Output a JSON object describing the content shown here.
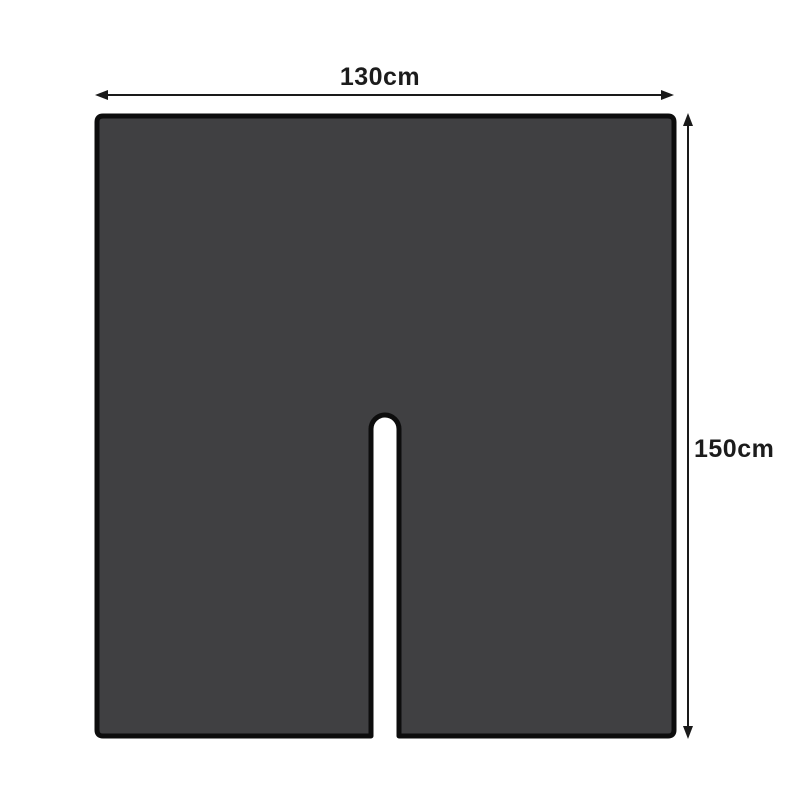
{
  "diagram": {
    "title": "u-shaped-cover-dimension-diagram",
    "width_dimension": {
      "label": "130cm"
    },
    "height_dimension": {
      "label": "150cm"
    },
    "shape": {
      "name": "square-cover-with-center-notch",
      "fill_color": "#404042",
      "outline_color": "#0d0d0d"
    },
    "arrow_color": "#1a1a1a",
    "label_color": "#1c1c1c",
    "background_color": "#ffffff"
  }
}
